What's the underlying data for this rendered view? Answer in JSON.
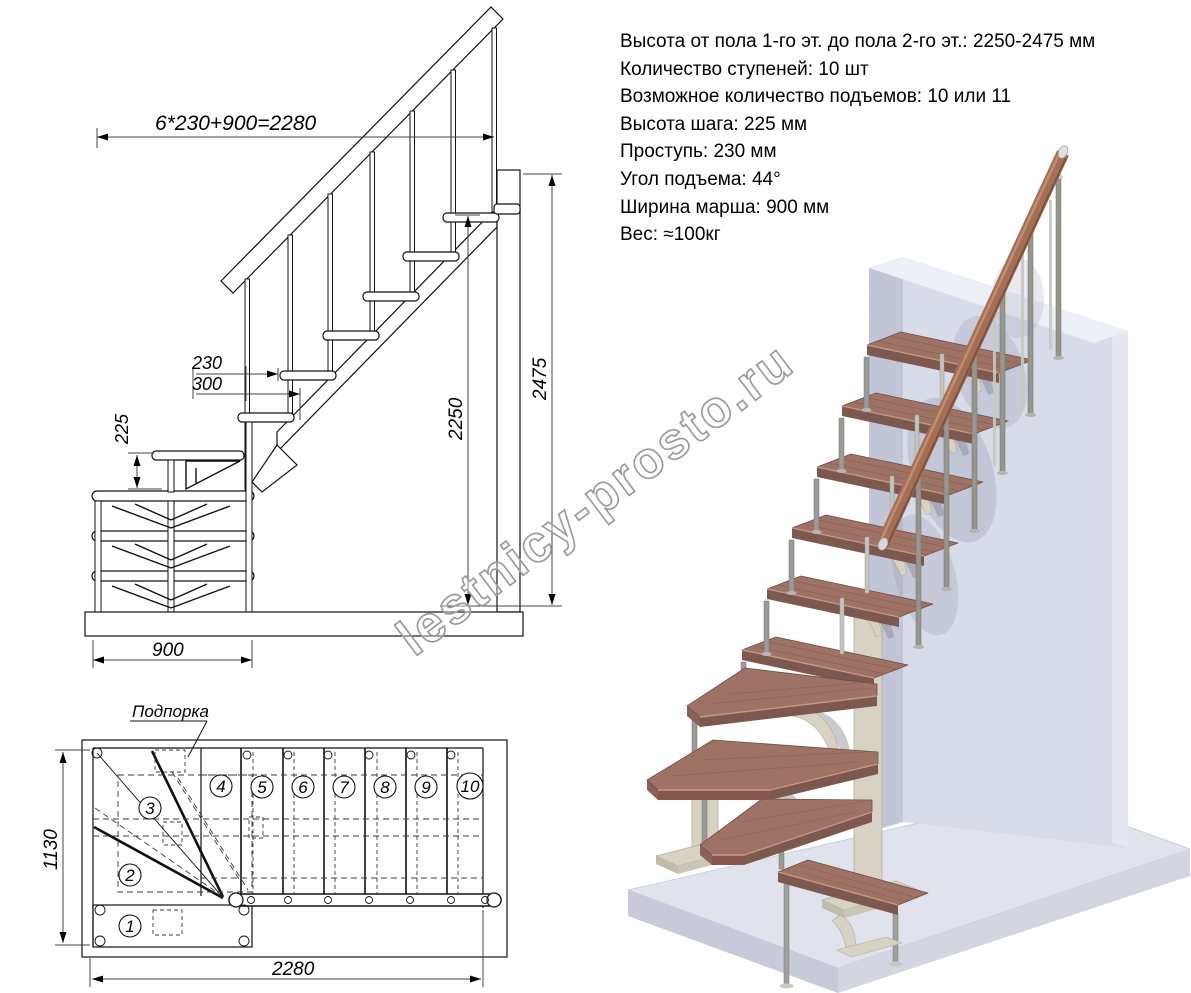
{
  "specs": {
    "lines": [
      "Высота от пола 1-го эт. до пола 2-го эт.: 2250-2475 мм",
      "Количество ступеней: 10 шт",
      "Возможное количество подъемов: 10 или 11",
      "Высота шага: 225 мм",
      "Проступь: 230 мм",
      "Угол подъема: 44°",
      "Ширина марша: 900 мм",
      "Вес: ≈100кг"
    ]
  },
  "elevation": {
    "dim_total_run": "6*230+900=2280",
    "dim_tread_run": "230",
    "dim_tread_depth": "300",
    "dim_riser": "225",
    "dim_height_floor": "2250",
    "dim_height_top": "2475",
    "dim_module_width": "900"
  },
  "plan": {
    "label_support": "Подпорка",
    "dim_width": "1130",
    "dim_length": "2280",
    "step_numbers": [
      "1",
      "2",
      "3",
      "4",
      "5",
      "6",
      "7",
      "8",
      "9",
      "10"
    ]
  },
  "watermark": "lestnicy-prosto.ru",
  "colors": {
    "line": "#111111",
    "tread_wood": "#9e7366",
    "handrail_wood": "#a36f55",
    "metal": "#9a9a96",
    "bracket_beige": "#d8d2c4",
    "wall": "#d8dbe8",
    "floor": "#e1e3ec"
  }
}
